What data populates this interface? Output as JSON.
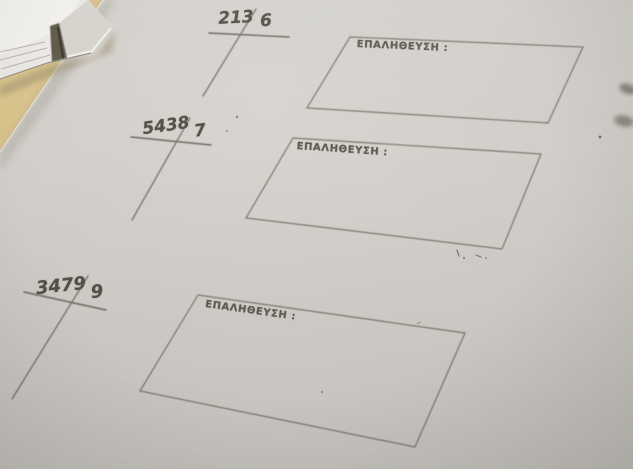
{
  "worksheet": {
    "problems": [
      {
        "dividend": "213",
        "divisor": "6"
      },
      {
        "dividend": "5438",
        "divisor": "7"
      },
      {
        "dividend": "3479",
        "divisor": "9"
      }
    ],
    "boxes": [
      {
        "label": "ΕΠΑΛΗΘΕΥΣΗ :"
      },
      {
        "label": "ΕΠΑΛΗΘΕΥΣΗ :"
      },
      {
        "label": "ΕΠΑΛΗΘΕΥΣΗ :"
      }
    ]
  },
  "colors": {
    "paper": "#cfccc7",
    "desk": "#d2bc84",
    "ink": "#55514b",
    "line": "#6d6963",
    "paper_stack": "#e9e7e3"
  }
}
